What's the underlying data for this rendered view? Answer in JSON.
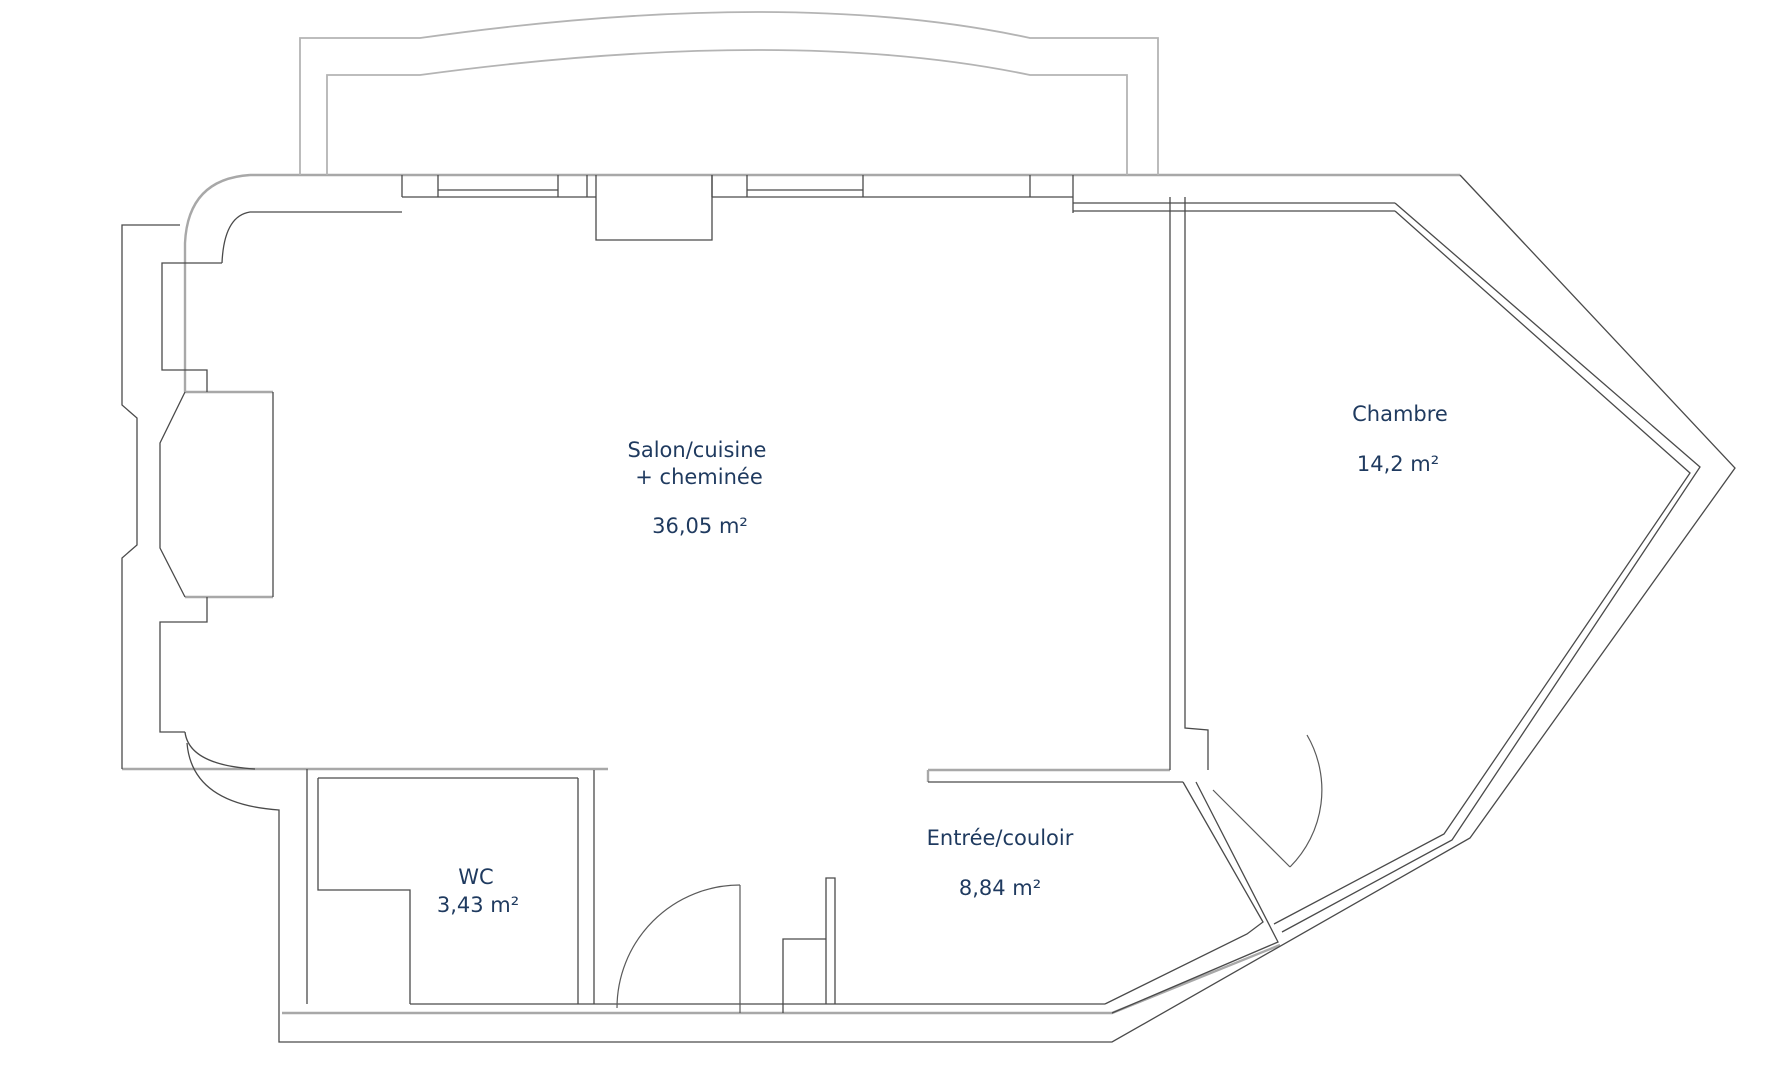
{
  "document": {
    "type": "floor-plan",
    "background": "#ffffff"
  },
  "colors": {
    "wall_dark": "#4a4a4a",
    "wall_light": "#a8a8a8",
    "balcony_light": "#b4b4b4",
    "label_text": "#1f3a5f"
  },
  "rooms": [
    {
      "id": "salon",
      "name": "Salon/cuisine",
      "name_line2": "+ cheminée",
      "area": "36,05 m²"
    },
    {
      "id": "chambre",
      "name": "Chambre",
      "area": "14,2 m²"
    },
    {
      "id": "wc",
      "name": "WC",
      "area": "3,43 m²"
    },
    {
      "id": "entree",
      "name": "Entrée/couloir",
      "area": "8,84 m²"
    }
  ]
}
